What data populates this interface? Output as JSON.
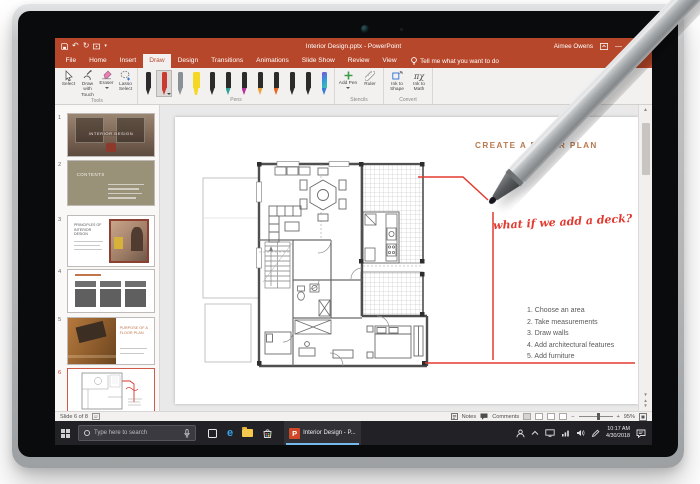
{
  "titlebar": {
    "title": "Interior Design.pptx - PowerPoint",
    "user": "Aimee Owens",
    "minimize": "—"
  },
  "ribbon": {
    "tabs": [
      "File",
      "Home",
      "Insert",
      "Draw",
      "Design",
      "Transitions",
      "Animations",
      "Slide Show",
      "Review",
      "View"
    ],
    "active_tab": "Draw",
    "tell_me": "Tell me what you want to do",
    "tools": [
      {
        "label": "Select"
      },
      {
        "label": "Draw with Touch"
      },
      {
        "label": "Eraser"
      },
      {
        "label": "Lasso Select"
      }
    ],
    "pens": [
      {
        "name": "black pen",
        "body": "#2b2b2b",
        "tip": "#2b2b2b",
        "selected": false
      },
      {
        "name": "red pen",
        "body": "#c93a30",
        "tip": "#c93a30",
        "selected": true
      },
      {
        "name": "gray pen",
        "body": "#8a9196",
        "tip": "#8a9196",
        "selected": false
      },
      {
        "name": "yellow highlighter",
        "body": "#f5d825",
        "tip": "#f5d825",
        "selected": false,
        "highlighter": true
      },
      {
        "name": "black pen",
        "body": "#2b2b2b",
        "tip": "#2b2b2b",
        "selected": false
      },
      {
        "name": "teal pen",
        "body": "#2b2b2b",
        "tip": "#2fa39a",
        "selected": false
      },
      {
        "name": "magenta pen",
        "body": "#2b2b2b",
        "tip": "#b5309b",
        "selected": false
      },
      {
        "name": "gold pen",
        "body": "#2b2b2b",
        "tip": "#eaa63c",
        "selected": false
      },
      {
        "name": "orange pen",
        "body": "#2b2b2b",
        "tip": "#e8661f",
        "selected": false
      },
      {
        "name": "black pen",
        "body": "#2b2b2b",
        "tip": "#2b2b2b",
        "selected": false
      },
      {
        "name": "black pen",
        "body": "#2b2b2b",
        "tip": "#2b2b2b",
        "selected": false
      },
      {
        "name": "galaxy pen",
        "body": "linear-gradient(135deg,#7b4fd8,#2f9fd8 55%,#46c5a8)",
        "tip": "#3a7bd5",
        "selected": false
      }
    ],
    "stencils": [
      {
        "label": "Add Pen"
      },
      {
        "label": "Ruler"
      }
    ],
    "convert": [
      {
        "label": "Ink to Shape"
      },
      {
        "label": "Ink to Math"
      }
    ],
    "groups": {
      "tools": "Tools",
      "pens": "Pens",
      "stencils": "Stencils",
      "convert": "Convert"
    }
  },
  "thumbnails": [
    {
      "number": "1",
      "title": "INTERIOR DESIGN",
      "selected": false
    },
    {
      "number": "2",
      "title": "CONTENTS",
      "selected": false
    },
    {
      "number": "3",
      "title": "PRINCIPLES OF INTERIOR DESIGN",
      "selected": false
    },
    {
      "number": "4",
      "title": "",
      "selected": false
    },
    {
      "number": "5",
      "title": "PURPOSE OF A FLOOR PLAN",
      "selected": false
    },
    {
      "number": "6",
      "title": "",
      "selected": true
    }
  ],
  "slide": {
    "title": "CREATE A FLOOR PLAN",
    "annotation": "what if we add a deck?",
    "steps": [
      "1. Choose an area",
      "2. Take measurements",
      "3. Draw walls",
      "4. Add architectural features",
      "5. Add furniture"
    ],
    "ink_color": "#e23a30"
  },
  "statusbar": {
    "slide_indicator": "Slide 6 of 8",
    "notes": "Notes",
    "comments": "Comments",
    "zoom": "95%"
  },
  "taskbar": {
    "search_placeholder": "Type here to search",
    "app_label": "Interior Design - P...",
    "time": "10:17 AM",
    "date": "4/30/2018"
  },
  "colors": {
    "accent": "#b7472a",
    "ink": "#e23a30",
    "slide_title": "#b97a4e"
  }
}
